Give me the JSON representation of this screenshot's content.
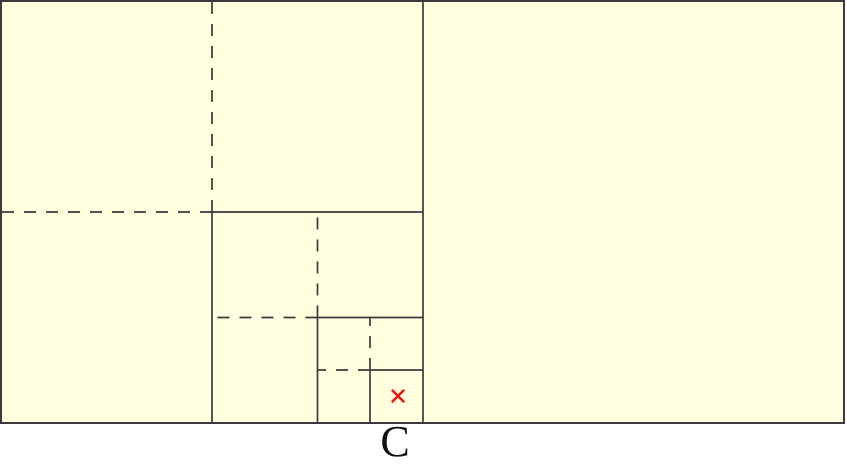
{
  "diagram": {
    "type": "nested-square-bisection-figure",
    "label": "C",
    "label_position": {
      "x": 395,
      "y": 420
    },
    "marker": {
      "symbol": "×",
      "x": 398,
      "y": 396,
      "size": 11
    },
    "colors": {
      "page_background": "#FFFFFF",
      "canvas_fill": "#FFFFDF",
      "line": "#3A3A3A",
      "marker": "#F20D0D",
      "label_text": "#111111"
    },
    "outer_rect": {
      "x": 1,
      "y": 1,
      "width": 843,
      "height": 422
    },
    "dash_pattern": "12 10",
    "line_width": 1.7,
    "outer_line_width": 2,
    "marker_line_width": 2.4,
    "lines": [
      {
        "name": "middle-divider-line",
        "x1": 423,
        "y1": 1,
        "x2": 423,
        "y2": 423,
        "style": "solid"
      },
      {
        "name": "level1-dashed-vertical-line",
        "x1": 212,
        "y1": 212,
        "x2": 212,
        "y2": 1,
        "style": "dashed"
      },
      {
        "name": "level1-dashed-horizontal-line",
        "x1": 212,
        "y1": 212,
        "x2": 1,
        "y2": 212,
        "style": "dashed"
      },
      {
        "name": "level1-solid-horizontal-line",
        "x1": 212,
        "y1": 212,
        "x2": 423,
        "y2": 212,
        "style": "solid"
      },
      {
        "name": "level1-solid-vertical-line",
        "x1": 212,
        "y1": 212,
        "x2": 212,
        "y2": 423,
        "style": "solid"
      },
      {
        "name": "level2-dashed-vertical-line",
        "x1": 317.5,
        "y1": 317.5,
        "x2": 317.5,
        "y2": 212,
        "style": "dashed"
      },
      {
        "name": "level2-dashed-horizontal-line",
        "x1": 317.5,
        "y1": 317.5,
        "x2": 212,
        "y2": 317.5,
        "style": "dashed"
      },
      {
        "name": "level2-solid-horizontal-line",
        "x1": 317.5,
        "y1": 317.5,
        "x2": 423,
        "y2": 317.5,
        "style": "solid"
      },
      {
        "name": "level2-solid-vertical-line",
        "x1": 317.5,
        "y1": 317.5,
        "x2": 317.5,
        "y2": 423,
        "style": "solid"
      },
      {
        "name": "level3-dashed-vertical-line",
        "x1": 370,
        "y1": 370,
        "x2": 370,
        "y2": 317.5,
        "style": "dashed"
      },
      {
        "name": "level3-dashed-horizontal-line",
        "x1": 370,
        "y1": 370,
        "x2": 317.5,
        "y2": 370,
        "style": "dashed"
      },
      {
        "name": "level3-solid-horizontal-line",
        "x1": 370,
        "y1": 370,
        "x2": 423,
        "y2": 370,
        "style": "solid"
      },
      {
        "name": "level3-solid-vertical-line",
        "x1": 370,
        "y1": 370,
        "x2": 370,
        "y2": 423,
        "style": "solid"
      }
    ]
  }
}
